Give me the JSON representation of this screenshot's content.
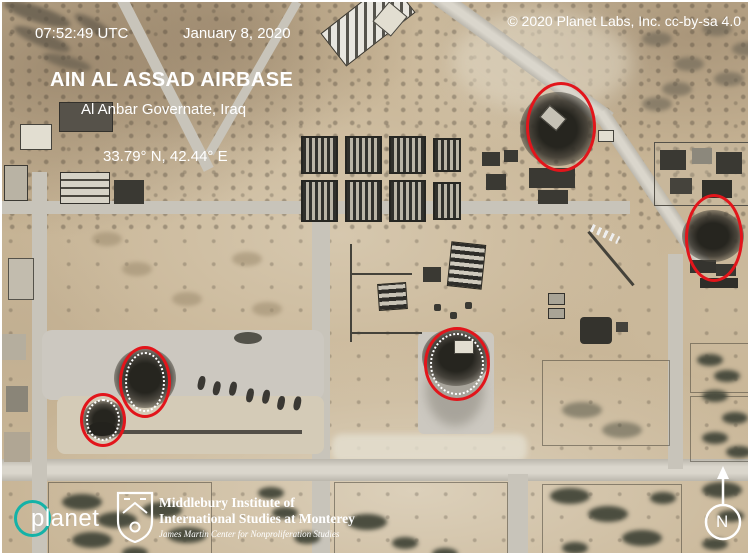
{
  "header": {
    "timestamp": "07:52:49 UTC",
    "date": "January 8, 2020",
    "copyright": "© 2020 Planet Labs, Inc. cc-by-sa 4.0"
  },
  "location": {
    "title": "AIN AL ASSAD AIRBASE",
    "subtitle": "Al Anbar Governate, Iraq",
    "coordinates": "33.79° N, 42.44° E"
  },
  "footer": {
    "planet_logo": "planet",
    "institute": {
      "line1": "Middlebury Institute of",
      "line2": "International Studies at Monterey",
      "line3": "James Martin Center for Nonproliferation Studies"
    },
    "compass_label": "N"
  },
  "annotations": {
    "stroke_color": "#e2151b",
    "inner_dot_color": "#ffffff",
    "circles": [
      {
        "id": "strike-1",
        "cx": 559,
        "cy": 125,
        "rx": 35,
        "ry": 45,
        "dotted_inner": false
      },
      {
        "id": "strike-2",
        "cx": 712,
        "cy": 236,
        "rx": 29,
        "ry": 44,
        "dotted_inner": false
      },
      {
        "id": "strike-3",
        "cx": 455,
        "cy": 362,
        "rx": 33,
        "ry": 37,
        "dotted_inner": true
      },
      {
        "id": "strike-4",
        "cx": 143,
        "cy": 380,
        "rx": 26,
        "ry": 36,
        "dotted_inner": true
      },
      {
        "id": "strike-5",
        "cx": 101,
        "cy": 418,
        "rx": 23,
        "ry": 27,
        "dotted_inner": true
      }
    ]
  },
  "colors": {
    "planet_teal": "#14b2a7",
    "text_white": "#ffffff",
    "annotation_red": "#e2151b"
  }
}
